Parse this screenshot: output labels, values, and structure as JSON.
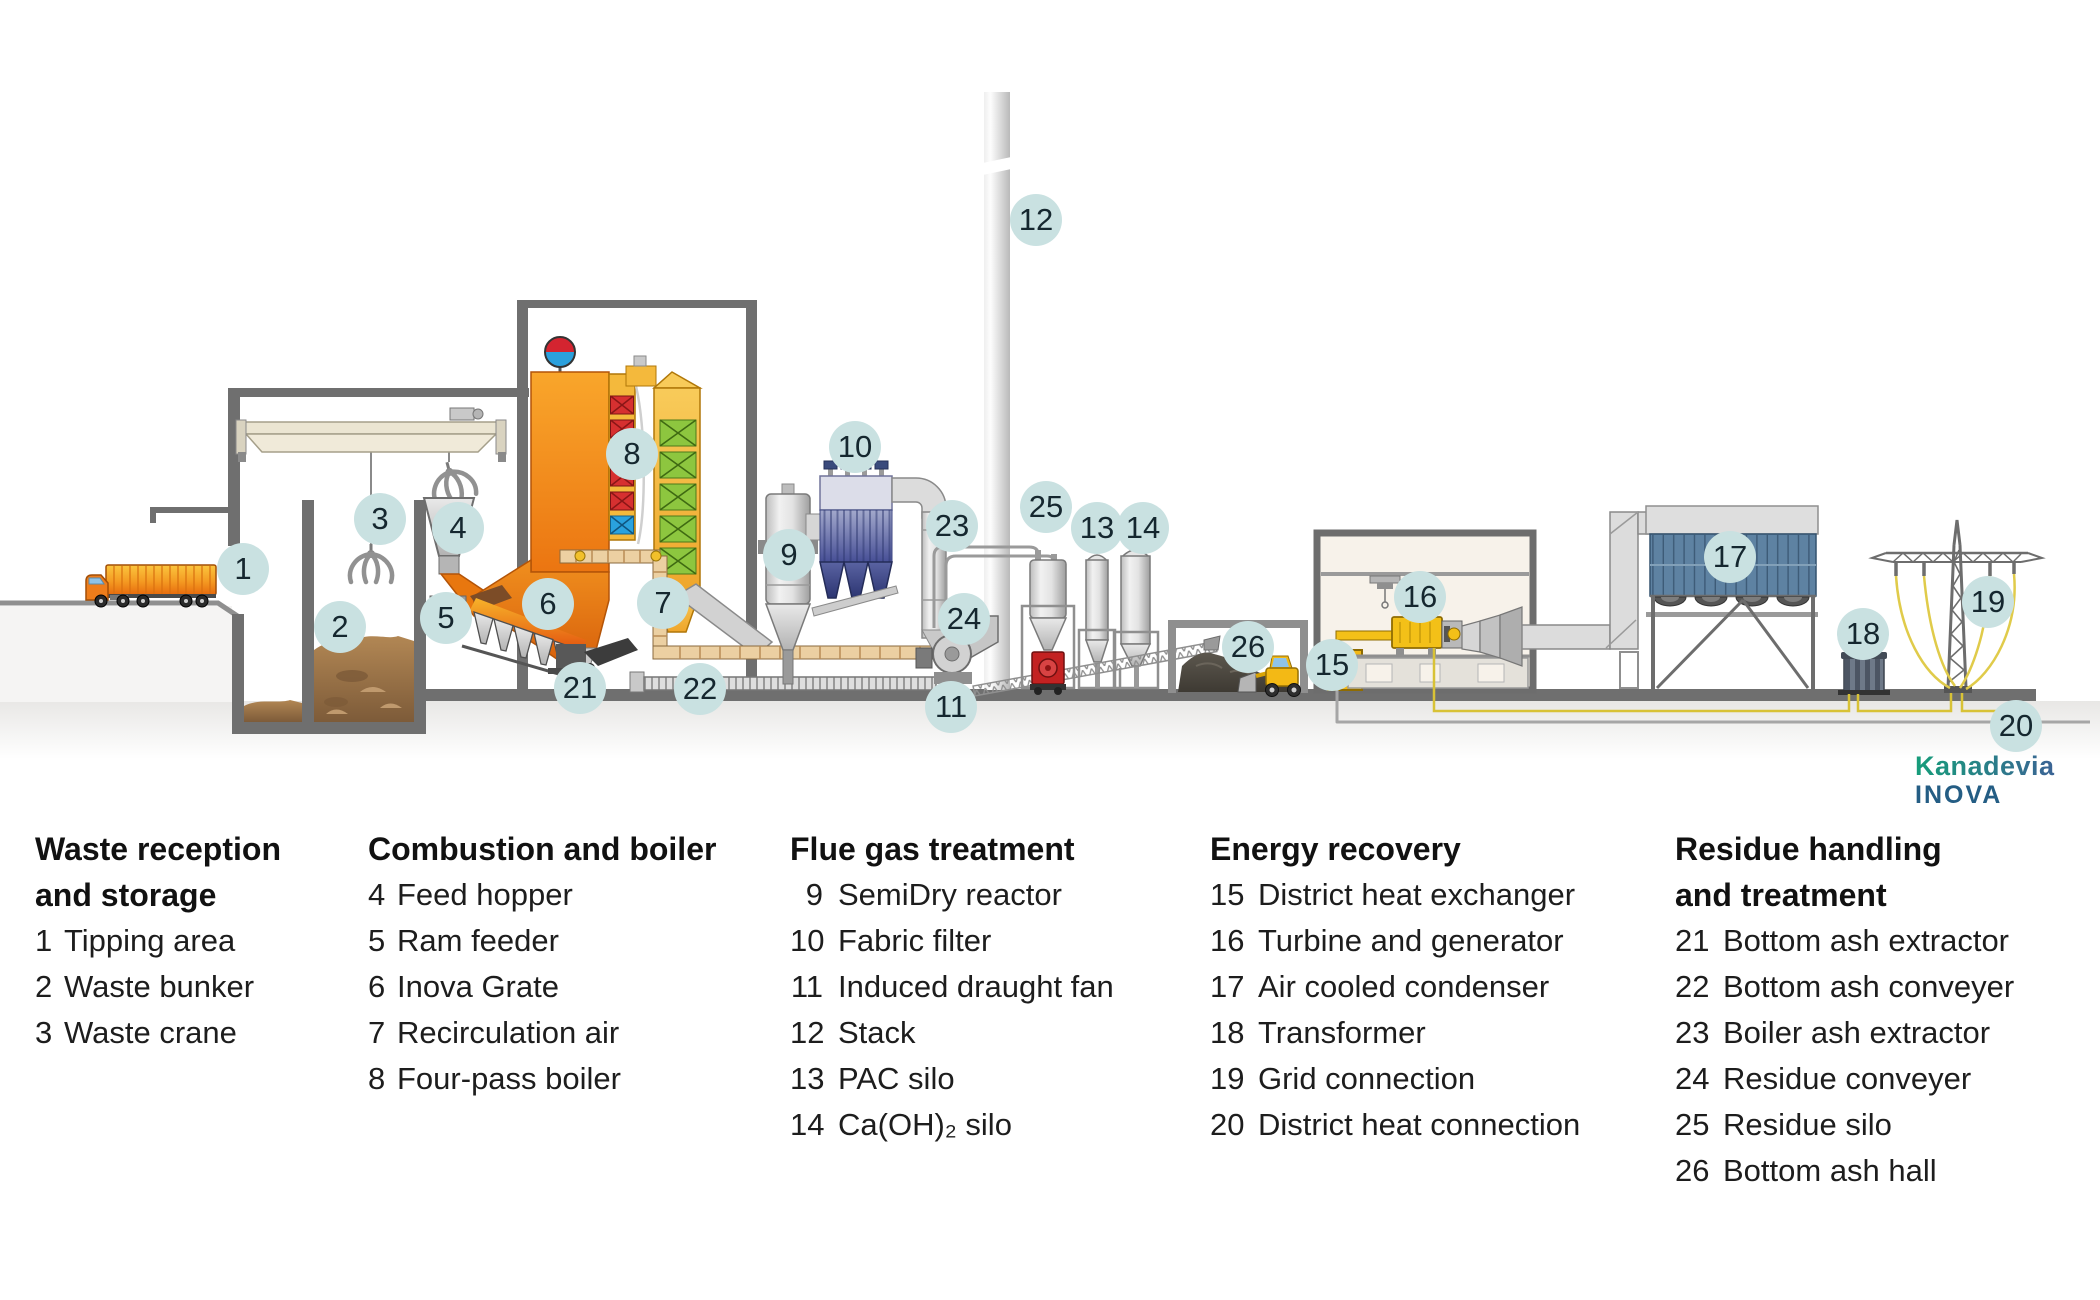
{
  "diagram": {
    "badges": [
      {
        "n": "1",
        "x": 243,
        "y": 569
      },
      {
        "n": "2",
        "x": 340,
        "y": 627
      },
      {
        "n": "3",
        "x": 380,
        "y": 519
      },
      {
        "n": "4",
        "x": 458,
        "y": 528
      },
      {
        "n": "5",
        "x": 446,
        "y": 618
      },
      {
        "n": "6",
        "x": 548,
        "y": 604
      },
      {
        "n": "7",
        "x": 663,
        "y": 603
      },
      {
        "n": "8",
        "x": 632,
        "y": 454
      },
      {
        "n": "9",
        "x": 789,
        "y": 555
      },
      {
        "n": "10",
        "x": 855,
        "y": 447
      },
      {
        "n": "11",
        "x": 951,
        "y": 707
      },
      {
        "n": "12",
        "x": 1036,
        "y": 220
      },
      {
        "n": "13",
        "x": 1097,
        "y": 528
      },
      {
        "n": "14",
        "x": 1143,
        "y": 528
      },
      {
        "n": "15",
        "x": 1332,
        "y": 665
      },
      {
        "n": "16",
        "x": 1420,
        "y": 597
      },
      {
        "n": "17",
        "x": 1730,
        "y": 557
      },
      {
        "n": "18",
        "x": 1863,
        "y": 634
      },
      {
        "n": "19",
        "x": 1988,
        "y": 602
      },
      {
        "n": "20",
        "x": 2016,
        "y": 726
      },
      {
        "n": "21",
        "x": 580,
        "y": 688
      },
      {
        "n": "22",
        "x": 700,
        "y": 689
      },
      {
        "n": "23",
        "x": 952,
        "y": 526
      },
      {
        "n": "24",
        "x": 964,
        "y": 619
      },
      {
        "n": "25",
        "x": 1046,
        "y": 507
      },
      {
        "n": "26",
        "x": 1248,
        "y": 647
      }
    ]
  },
  "legend": {
    "groups": [
      {
        "title": "Waste reception\nand storage",
        "items": [
          {
            "n": "1",
            "label": "Tipping area"
          },
          {
            "n": "2",
            "label": "Waste bunker"
          },
          {
            "n": "3",
            "label": "Waste crane"
          }
        ]
      },
      {
        "title": "Combustion and boiler",
        "items": [
          {
            "n": "4",
            "label": "Feed hopper"
          },
          {
            "n": "5",
            "label": "Ram feeder"
          },
          {
            "n": "6",
            "label": "Inova Grate"
          },
          {
            "n": "7",
            "label": "Recirculation air"
          },
          {
            "n": "8",
            "label": "Four-pass boiler"
          }
        ]
      },
      {
        "title": "Flue gas treatment",
        "items": [
          {
            "n": "9",
            "label": "SemiDry reactor"
          },
          {
            "n": "10",
            "label": "Fabric filter"
          },
          {
            "n": "11",
            "label": "Induced draught fan"
          },
          {
            "n": "12",
            "label": "Stack"
          },
          {
            "n": "13",
            "label": "PAC silo"
          },
          {
            "n": "14",
            "label": "Ca(OH)₂ silo"
          }
        ]
      },
      {
        "title": "Energy recovery",
        "items": [
          {
            "n": "15",
            "label": "District heat exchanger"
          },
          {
            "n": "16",
            "label": "Turbine and generator"
          },
          {
            "n": "17",
            "label": "Air cooled condenser"
          },
          {
            "n": "18",
            "label": "Transformer"
          },
          {
            "n": "19",
            "label": "Grid connection"
          },
          {
            "n": "20",
            "label": "District heat connection"
          }
        ]
      },
      {
        "title": "Residue handling\nand treatment",
        "items": [
          {
            "n": "21",
            "label": "Bottom ash extractor"
          },
          {
            "n": "22",
            "label": "Bottom ash conveyer"
          },
          {
            "n": "23",
            "label": "Boiler ash extractor"
          },
          {
            "n": "24",
            "label": "Residue conveyer"
          },
          {
            "n": "25",
            "label": "Residue silo"
          },
          {
            "n": "26",
            "label": "Bottom ash hall"
          }
        ]
      }
    ]
  },
  "logo": {
    "line1": "Kanadevia",
    "line2": "INOVA"
  },
  "colors": {
    "badge_bg": "#c9e1e1",
    "badge_fg": "#15272f",
    "brand_green": "#169d7a",
    "brand_blue": "#3b6395",
    "brand_navy": "#245d84",
    "furnace_orange": "#ee7d12",
    "boiler_amber": "#f2b53c",
    "heat_block_red": "#d63030",
    "heat_block_green": "#8dc63f",
    "heat_block_blue": "#2aa2de",
    "filter_blue": "#4a549c",
    "condenser_blue": "#5e82a2",
    "machine_yellow": "#f3c018",
    "cable_yellow": "#d8c236",
    "waste_brown": "#a07a4c",
    "ground_gray": "#6f6f6f"
  }
}
